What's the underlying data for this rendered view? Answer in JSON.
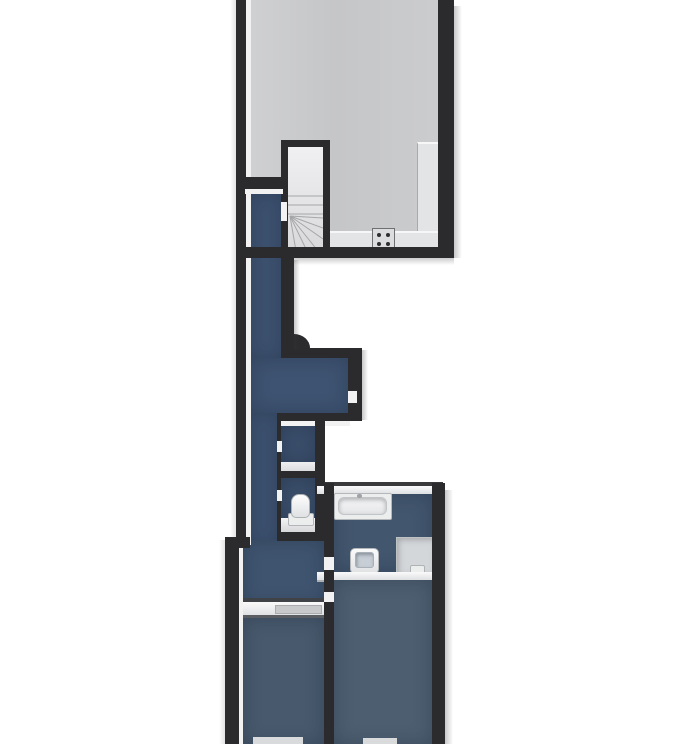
{
  "palette": {
    "background": "#ffffff",
    "wall": "#2b2b2d",
    "trim": "#f2f2f3",
    "shadow": "#8a8a8f"
  },
  "rooms": {
    "top_room": {
      "fill": "#c7c8ca"
    },
    "corridor": {
      "fill": "#3d5270"
    },
    "corridor_wide": {
      "fill": "#3e5371"
    },
    "closet": {
      "fill": "#3a4e6b"
    },
    "wc": {
      "fill": "#3a4e6a"
    },
    "landing": {
      "fill": "#3f546f"
    },
    "bathroom": {
      "fill": "#42566e"
    },
    "bedroom_left": {
      "fill": "#48596d"
    },
    "bedroom_right": {
      "fill": "#4c5e70"
    }
  },
  "fixtures": {
    "kitchen_counter": {
      "fill": "#e3e4e6"
    },
    "cooktop": {
      "fill": "#dcdddf"
    },
    "stairs": {
      "fill": "#e9e9eb"
    },
    "stair_line": {
      "fill": "#a5a6a8"
    },
    "bathtub": {
      "fill": "#eceded"
    },
    "shower": {
      "fill": "#d4d7da"
    },
    "shower_drain": {
      "fill": "#eceded"
    },
    "sink": {
      "fill": "#f2f3f4"
    },
    "sink_basin": {
      "fill": "#c7ced6"
    },
    "toilet": {
      "fill": "#f0f1f2"
    },
    "window_sill": {
      "fill": "#d9dadb"
    },
    "door_marker": {
      "fill": "#f2f2f3"
    }
  }
}
